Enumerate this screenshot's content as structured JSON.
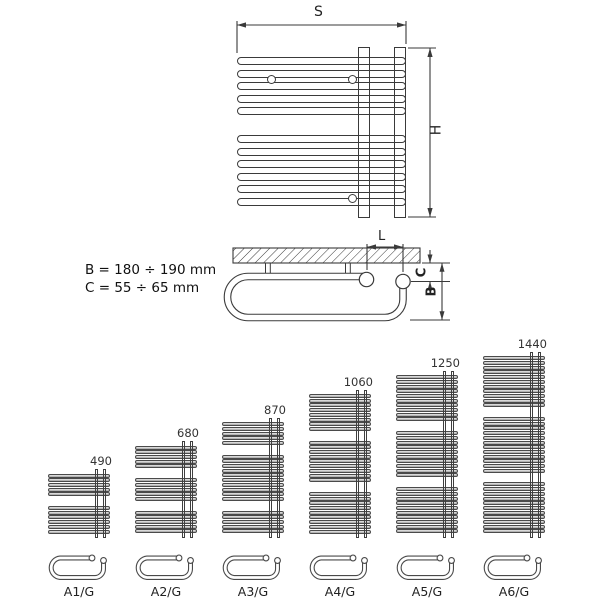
{
  "front_view": {
    "width_dim_label": "S",
    "height_dim_label": "H",
    "tube_groups": [
      5,
      6
    ]
  },
  "side_view": {
    "spacing_dim_label": "L",
    "wall_offset_dim_label": "C",
    "depth_dim_label": "B"
  },
  "notes": {
    "b_range": "B = 180 ÷ 190 mm",
    "c_range": "C = 55 ÷ 65 mm"
  },
  "colors": {
    "line": "#3a3a3a",
    "tube_fill": "#b4b4b4",
    "background": "#ffffff"
  },
  "variants": [
    {
      "model": "A1/G",
      "height": "490",
      "tube_groups": [
        5,
        6
      ]
    },
    {
      "model": "A2/G",
      "height": "680",
      "tube_groups": [
        5,
        5,
        5
      ]
    },
    {
      "model": "A3/G",
      "height": "870",
      "tube_groups": [
        5,
        10,
        5
      ]
    },
    {
      "model": "A4/G",
      "height": "1060",
      "tube_groups": [
        8,
        9,
        9
      ]
    },
    {
      "model": "A5/G",
      "height": "1250",
      "tube_groups": [
        10,
        10,
        10
      ]
    },
    {
      "model": "A6/G",
      "height": "1440",
      "tube_groups": [
        11,
        12,
        11
      ]
    }
  ]
}
